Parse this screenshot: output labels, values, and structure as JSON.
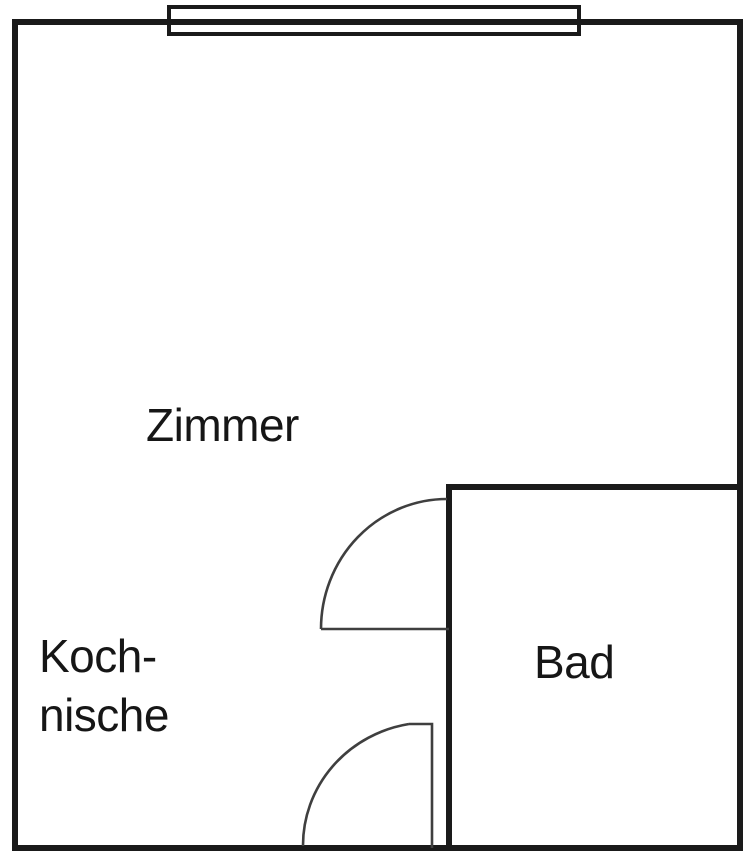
{
  "page": {
    "width": 750,
    "height": 858,
    "background": "#ffffff"
  },
  "floorplan": {
    "colors": {
      "wall_ink": "#1a1a1a",
      "door_ink": "#3f3f3f",
      "text_ink": "#161616"
    },
    "font_size": 46,
    "outer_wall": {
      "x": 15,
      "y": 22,
      "width": 725,
      "height": 826,
      "stroke_width": 6
    },
    "window": {
      "x": 169,
      "y": 7,
      "width": 410,
      "height": 27,
      "stroke_width": 4
    },
    "bathroom_walls": {
      "top": {
        "x1": 446,
        "y1": 487,
        "x2": 743,
        "y2": 487,
        "stroke_width": 6
      },
      "left": {
        "x1": 449,
        "y1": 484,
        "x2": 449,
        "y2": 851,
        "stroke_width": 6
      }
    },
    "doors": {
      "bathroom_door": {
        "swing_d": "M 447 499 A 126 130 0 0 0 321 629",
        "leaf_d": "M 321 629 L 449 629",
        "stroke_width": 2.6
      },
      "entrance_door": {
        "swing_d": "M 303 846 A 127 123 0 0 1 409 724",
        "leaf_d": "M 409 724 L 432 724 L 432 848",
        "stroke_width": 2.6
      }
    },
    "labels": {
      "zimmer": {
        "text": "Zimmer",
        "x": 146,
        "y": 441
      },
      "koch_line1": {
        "text": "Koch-",
        "x": 39,
        "y": 672
      },
      "koch_line2": {
        "text": "nische",
        "x": 39,
        "y": 731
      },
      "bad": {
        "text": "Bad",
        "x": 534,
        "y": 678
      }
    }
  }
}
